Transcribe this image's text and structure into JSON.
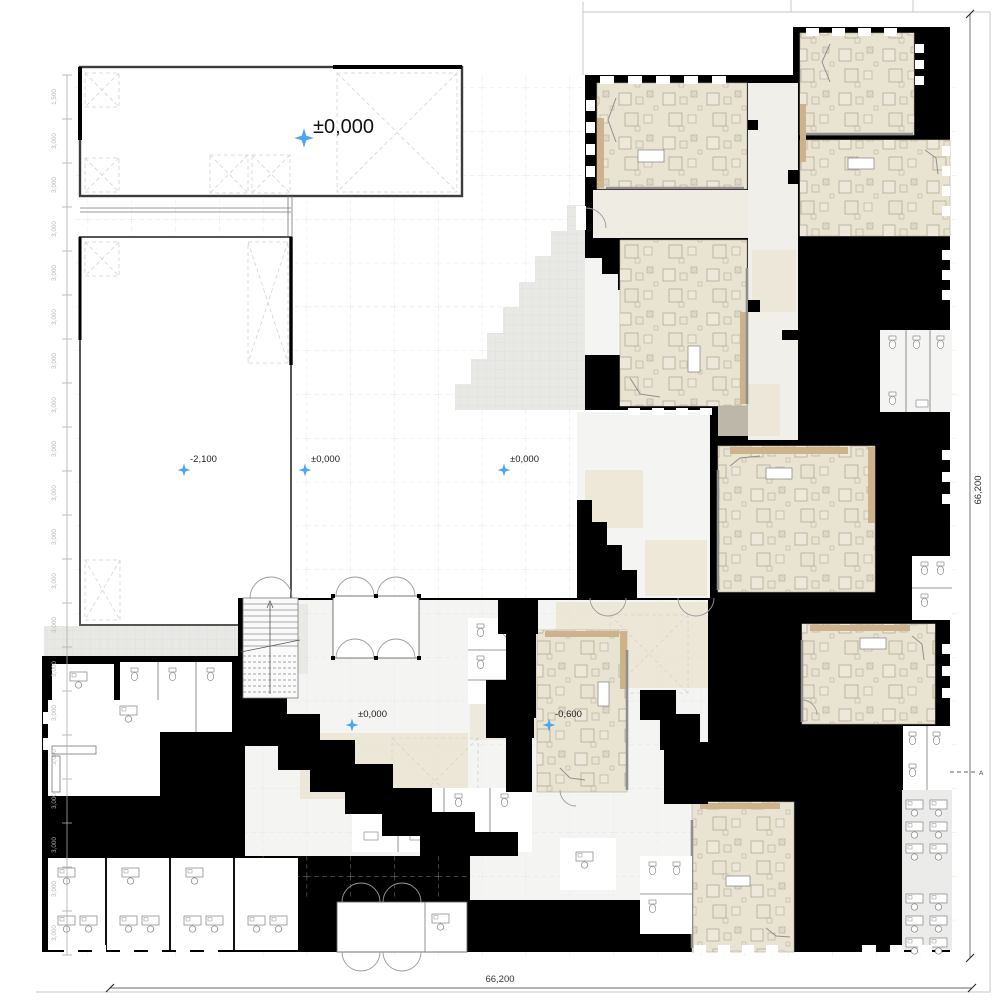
{
  "plan": {
    "elevation_markers": [
      {
        "id": "hall-main",
        "label": "±0,000"
      },
      {
        "id": "hall-lower",
        "label": "-2,100"
      },
      {
        "id": "hall-east",
        "label": "±0,000"
      },
      {
        "id": "courtyard",
        "label": "±0,000"
      },
      {
        "id": "foyer",
        "label": "±0,000"
      },
      {
        "id": "classroom-south",
        "label": "-0,600"
      }
    ],
    "dimensions": {
      "bottom": "66,200",
      "right": "66,200"
    },
    "ruler": {
      "tick_label": "3,000",
      "first_label": "1,500",
      "tick_count": 20
    },
    "section_marker": "A",
    "colors": {
      "walls": "#000000",
      "classroom_floor": "#e9e3d2",
      "wood_accent": "#cdb28c",
      "terrain": "#e8e8e5",
      "marker_blue": "#4aa5f2"
    }
  }
}
